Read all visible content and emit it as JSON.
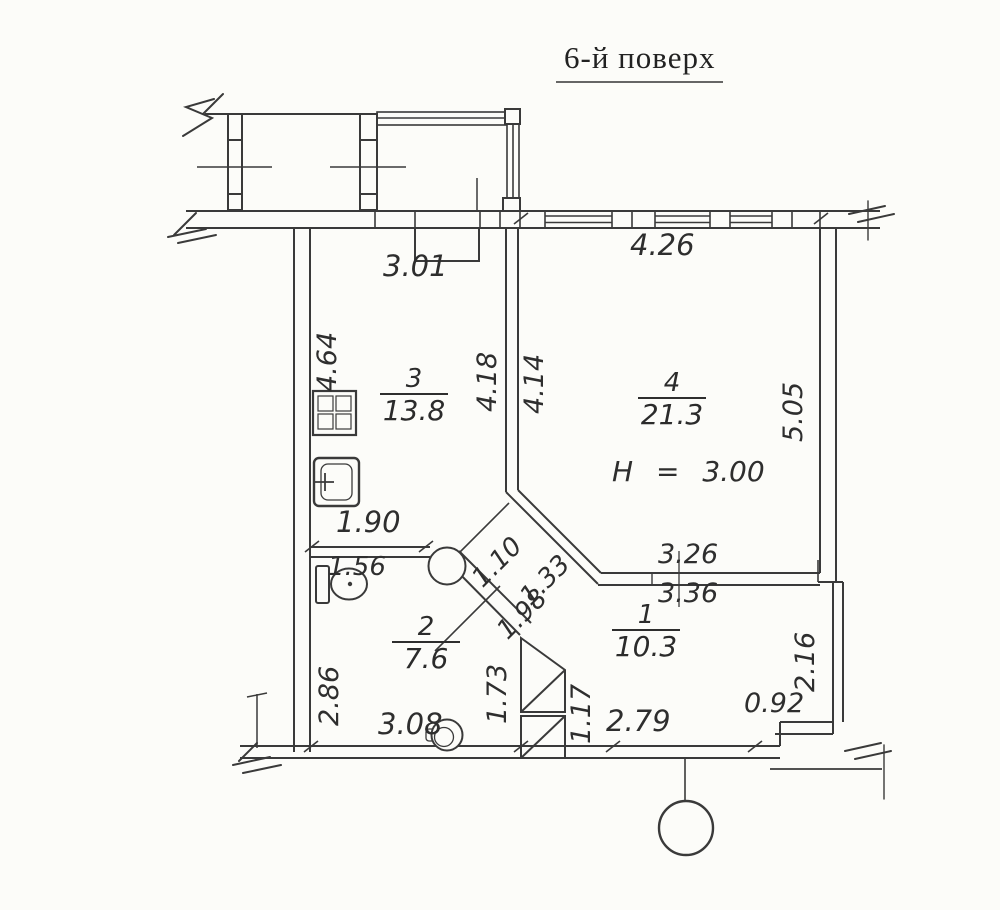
{
  "title": "6-й поверх",
  "plan": {
    "ceiling_height_note": "H = 3.00",
    "rooms": [
      {
        "number": "1",
        "area": "10.3"
      },
      {
        "number": "2",
        "area": "7.6"
      },
      {
        "number": "3",
        "area": "13.8"
      },
      {
        "number": "4",
        "area": "21.3"
      }
    ],
    "dimensions": {
      "d3_01": "3.01",
      "d4_26": "4.26",
      "d4_64": "4.64",
      "d4_18": "4.18",
      "d4_14": "4.14",
      "d5_05": "5.05",
      "d1_90": "1.90",
      "d1_56": "1.56",
      "d1_10": "1.10",
      "d1_33": "1.33",
      "d1_98": "1.98",
      "d3_26": "3.26",
      "d3_36": "3.36",
      "d2_86": "2.86",
      "d1_73": "1.73",
      "d1_17": "1.17",
      "d2_16": "2.16",
      "d3_08": "3.08",
      "d2_79": "2.79",
      "d0_92": "0.92"
    },
    "fixtures": [
      "stove-icon",
      "sink-icon",
      "toilet-icon",
      "washbasin-icon",
      "bidet-icon",
      "callout-circle"
    ],
    "colors": {
      "line": "#3a3a3a",
      "background": "#fcfcf9"
    }
  }
}
